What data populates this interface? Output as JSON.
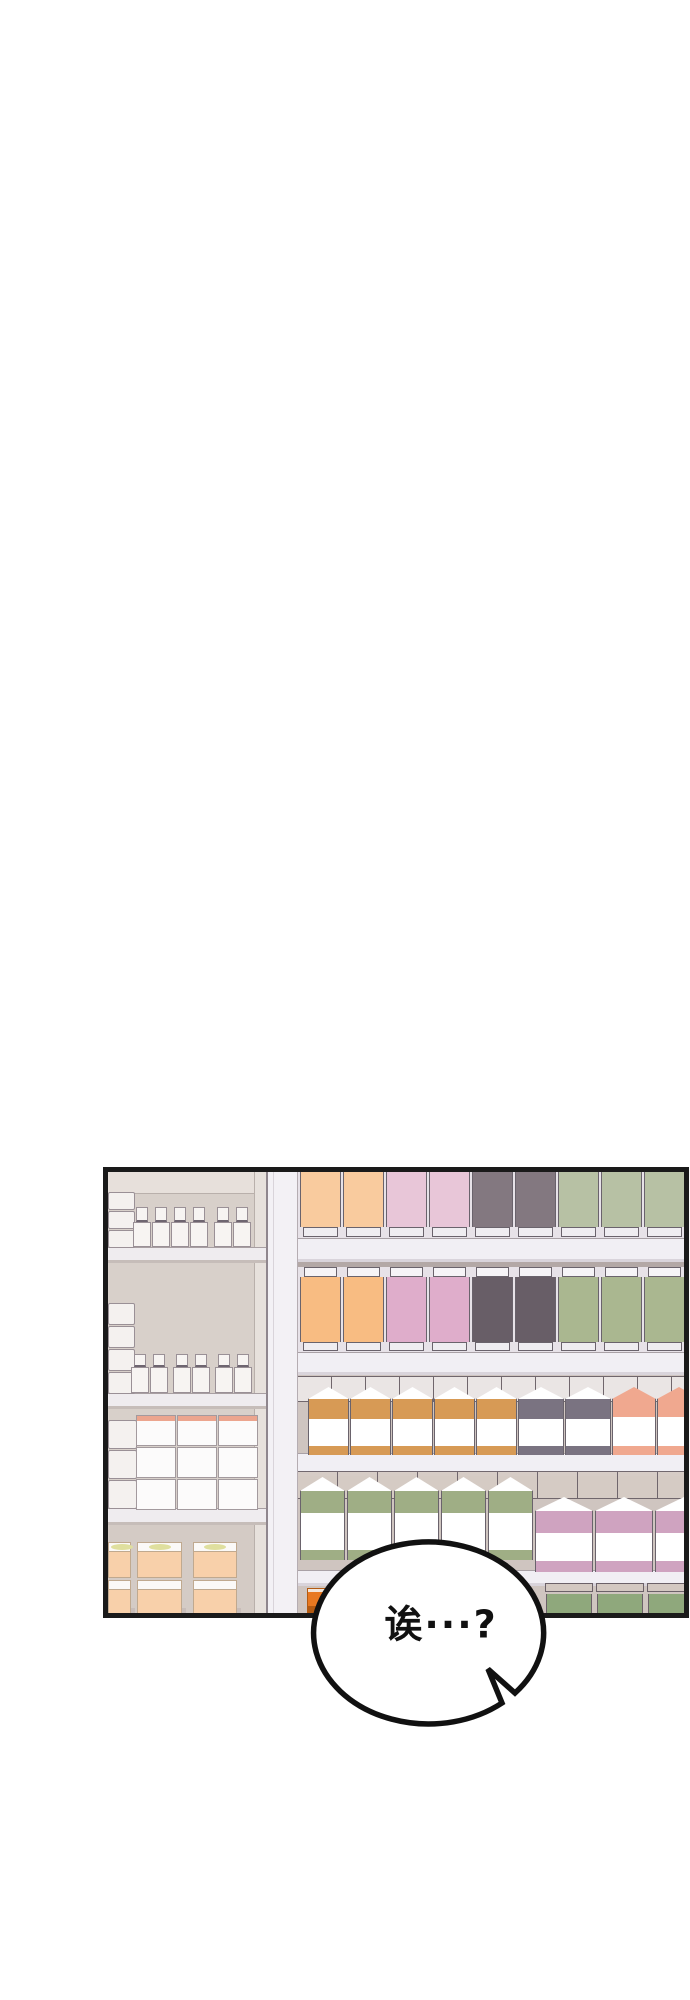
{
  "page": {
    "width": 690,
    "height": 2000,
    "background": "#ffffff"
  },
  "panel": {
    "x": 103,
    "y": 1167,
    "width": 586,
    "height": 451,
    "border_color": "#1a1a1a",
    "border_width": 5,
    "left_section": {
      "x0": 108,
      "x1": 266,
      "wall": "#d8d0ca",
      "wall_top": "#e7e0db",
      "wall_top_h": 21,
      "wall_line": "#b9b0ab",
      "wall_lower": "#d4cbc5",
      "side_panel": "#e7e1dc",
      "side_panel_x": 254,
      "board_fill": "#efecef",
      "board_edge": "#a89fa2",
      "board_shadow": "#c6bdb9",
      "boards": [
        {
          "y": 1247,
          "h": 13
        },
        {
          "y": 1393,
          "h": 13
        },
        {
          "y": 1508,
          "h": 14
        }
      ],
      "stack_fill": "#f4f1ef",
      "stack_outline": "#9a9096",
      "stacks": [
        {
          "x": 108,
          "y": 1192,
          "w": 27,
          "n": 3,
          "bh": 19
        },
        {
          "x": 108,
          "y": 1303,
          "w": 27,
          "n": 4,
          "bh": 23
        },
        {
          "x": 108,
          "y": 1420,
          "w": 29,
          "n": 3,
          "bh": 30
        }
      ],
      "bottle_fill": "#f7f4f2",
      "bottle_outline": "#9a9096",
      "bottle_cap_line": "#6e6570",
      "bottle_rows": [
        {
          "shelf_y": 1247,
          "cap_h": 15,
          "body_h": 25,
          "w": 18,
          "xs": [
            133,
            152,
            171,
            190,
            214,
            233
          ]
        },
        {
          "shelf_y": 1393,
          "cap_h": 13,
          "body_h": 26,
          "w": 18,
          "xs": [
            131,
            150,
            173,
            192,
            215,
            234
          ]
        }
      ],
      "grid": {
        "x": 136,
        "y": 1415,
        "cols": 3,
        "rows": 3,
        "cw": 40,
        "ch": 31,
        "fill": "#fcfbfb",
        "outline": "#a39a9e",
        "trim": "#eca58e"
      },
      "peach": {
        "y": 1542,
        "row_h": 36,
        "lid_h": 9,
        "cols": [
          {
            "x": 108,
            "w": 23
          },
          {
            "x": 137,
            "w": 45
          },
          {
            "x": 193,
            "w": 44
          }
        ],
        "fill": "#f8d0aa",
        "lid": "#fbf9f7",
        "outline": "#c0a98f",
        "oval": "#dfdf9e",
        "shadow": "#bdb3ae"
      }
    },
    "pillar": {
      "x": 266,
      "w": 32,
      "fill": "#f3f1f5",
      "edge_left": "#8f868d",
      "inner_line": "#d9d4da",
      "edge_right": "#b5adb2"
    },
    "right_section": {
      "x": 298,
      "x_end": 685,
      "wall": "#cfc5c0",
      "board_fill": "#f1eff4",
      "board_edge": "#a9a1a6",
      "board_shadow": "#d9d4db",
      "dark_strip": "#b3a8a6",
      "backing": "#e7e2e8",
      "carton_outline": "#6a636c",
      "base_fill": "#efedf1",
      "cap_fill": "#f6f4f7",
      "clutter_line": "#6b6168",
      "boards": [
        {
          "y": 1238,
          "h": 21
        },
        {
          "y": 1352,
          "h": 20
        },
        {
          "y": 1453,
          "h": 20
        },
        {
          "y": 1570,
          "h": 13
        }
      ],
      "dark_strips": [
        {
          "y": 1261,
          "h": 11
        }
      ],
      "tall_rows": [
        {
          "y": 1171,
          "cap_h": 0,
          "body_h": 56,
          "base_h": 11,
          "x": 300,
          "w": 41,
          "gap": 2,
          "colors": [
            "#f9cb9e",
            "#f9cb9e",
            "#e8c6d8",
            "#e8c6d8",
            "#837880",
            "#837880",
            "#b7c1a4",
            "#b7c1a4",
            "#b7c1a4"
          ]
        },
        {
          "y": 1267,
          "cap_h": 10,
          "body_h": 65,
          "base_h": 10,
          "x": 300,
          "w": 41,
          "gap": 2,
          "colors": [
            "#f8bc82",
            "#f8bc82",
            "#dfadcb",
            "#dfadcb",
            "#685e67",
            "#685e67",
            "#aab790",
            "#aab790",
            "#aab790"
          ]
        }
      ],
      "gable_rows": [
        {
          "x": 308,
          "gap": 1,
          "clutter": {
            "y": 1376,
            "h": 24,
            "fill": "#ece7e6",
            "tile": 34
          },
          "groups": [
            {
              "n": 5,
              "w": 41,
              "y": 1387,
              "h": 68,
              "band": "#d79a55",
              "gable_h": 12,
              "band_h": 20,
              "bottom_h": 9,
              "colored_gable": false
            },
            {
              "n": 2,
              "w": 46,
              "y": 1387,
              "h": 68,
              "band": "#7a7381",
              "gable_h": 12,
              "band_h": 20,
              "bottom_h": 9,
              "colored_gable": false
            },
            {
              "n": 2,
              "w": 44,
              "y": 1387,
              "h": 68,
              "band": "#f0a88f",
              "gable_h": 12,
              "band_h": 18,
              "bottom_h": 9,
              "colored_gable": true
            }
          ]
        },
        {
          "x": 300,
          "gap": 2,
          "clutter": {
            "y": 1471,
            "h": 26,
            "fill": "#d6ccc5",
            "tile": 40
          },
          "groups": [
            {
              "n": 5,
              "w": 45,
              "y": 1477,
              "h": 83,
              "band": "#9fae85",
              "gable_h": 14,
              "band_h": 22,
              "bottom_h": 10,
              "colored_gable": false
            },
            {
              "n": 3,
              "w": 58,
              "y": 1497,
              "h": 75,
              "band": "#cfa3c0",
              "gable_h": 14,
              "band_h": 22,
              "bottom_h": 11,
              "colored_gable": false
            }
          ]
        }
      ],
      "row5": {
        "y": 1583,
        "x": 545,
        "n": 3,
        "w": 48,
        "gap": 3,
        "tan": "#d3c8c1",
        "green": "#8fa87c",
        "outline": "#6b6168"
      },
      "crate": {
        "x": 307,
        "y": 1588,
        "w": 30,
        "h": 25,
        "fill": "#e87820",
        "line": "#b35a12"
      }
    }
  },
  "bubble": {
    "cx": 440,
    "cy": 1624,
    "rx": 115,
    "ry": 91,
    "fill": "#ffffff",
    "stroke": "#111111",
    "stroke_width": 5.5,
    "tail_points": [
      [
        502,
        1703
      ],
      [
        488,
        1669
      ],
      [
        515,
        1693
      ]
    ],
    "text": "诶···?",
    "font_size": 38,
    "text_color": "#111111",
    "text_x": 441,
    "text_y": 1621
  }
}
